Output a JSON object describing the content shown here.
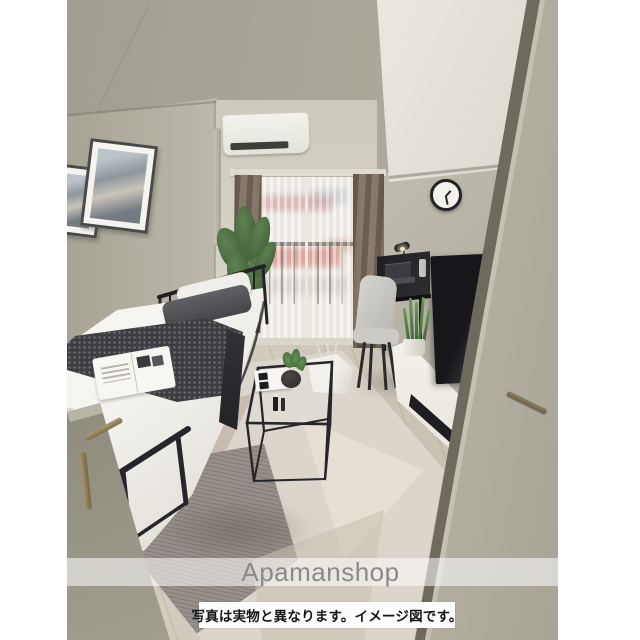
{
  "meta": {
    "description": "Real-estate listing photo: 3D rendered interior of a furnished studio apartment"
  },
  "watermark": {
    "text": "Apamanshop",
    "text_color": "#8a8a8a",
    "band_color": "rgba(255,255,255,0.55)"
  },
  "caption": {
    "text": "写真は実物と異なります。イメージ図です。",
    "text_color": "#151515",
    "background": "#fcfcfc"
  },
  "palette": {
    "page_margin": "#ffffff",
    "wall": "#b3b0a3",
    "ceiling": "#a9a699",
    "soffit": "#eae8df",
    "floor_wood": "#cec8b9",
    "curtain_drape": "#7b6e60",
    "sheer": "#e9e7e0",
    "bedding_white": "#f5f4f0",
    "blanket_dark": "#3e3e42",
    "tv_black": "#17171b",
    "tv_stand_white": "#f3f1ea",
    "plant_green": "#4e7042",
    "door_right": "#a8a496",
    "door_left": "#8e8b7c",
    "handle_brass": "#a6956e"
  },
  "scene": {
    "objects": [
      "air-conditioner",
      "window",
      "sheer-curtain",
      "drape-curtains",
      "balcony-railing",
      "wall-clock",
      "framed-art",
      "potted-plant",
      "single-bed",
      "pillows",
      "throw-blanket",
      "magazine",
      "coffee-table",
      "storage-basket",
      "desk",
      "laptop",
      "desk-lamp",
      "desk-chair",
      "snake-plant",
      "television",
      "tv-stand",
      "area-rug",
      "open-door-right",
      "open-door-left"
    ]
  }
}
